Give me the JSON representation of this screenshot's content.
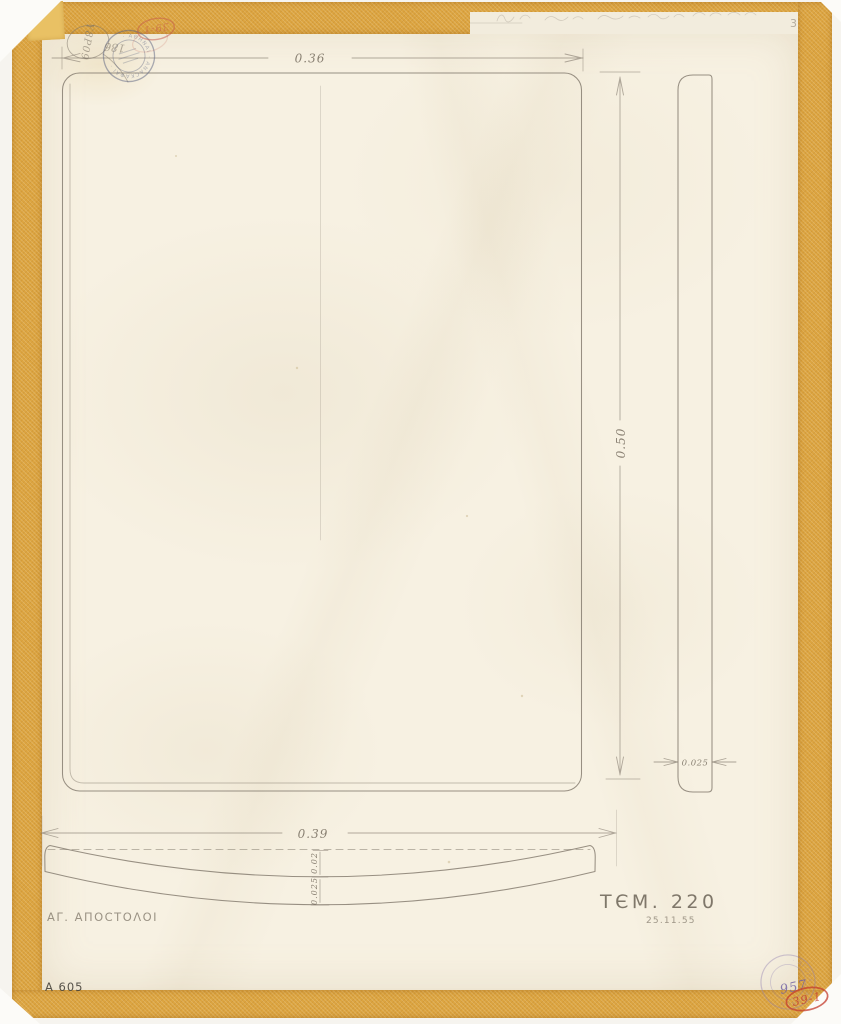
{
  "sheet": {
    "dimensions": {
      "front_width": "0.36",
      "front_height": "0.50",
      "side_thickness": "0.025",
      "bottom_width": "0.39",
      "bottom_rise": "0.02",
      "bottom_thickness": "0.025"
    },
    "inscriptions": {
      "site_name": "ΑΓ. ΑΠΟCΤΟΛΟΙ",
      "item_ref": "ΤЄΜ. 220",
      "date": "25.11.55",
      "inventory_no": "A 605",
      "page_no": "3",
      "balloon_note": "Υ8Ρ09",
      "stamp_note": "186"
    },
    "stamps": {
      "red_oval_top": "39-1",
      "red_oval_bottom": "39-1",
      "violet_number": "957",
      "navy_ring_text": "· ΑΘΗΝΑΙ · ΑΝΑCΚΑΦΑΙ ·",
      "violet_ring_text": "· ΑΓΟΡΑ · ΑΘΗΝΩΝ ·"
    },
    "colors": {
      "tape": "#dca440",
      "paper": "#f7f1e2",
      "pencil": "#80776a",
      "stamp_navy": "#59627f",
      "stamp_red": "#c4564a",
      "stamp_violet": "#8d7bb0"
    }
  }
}
